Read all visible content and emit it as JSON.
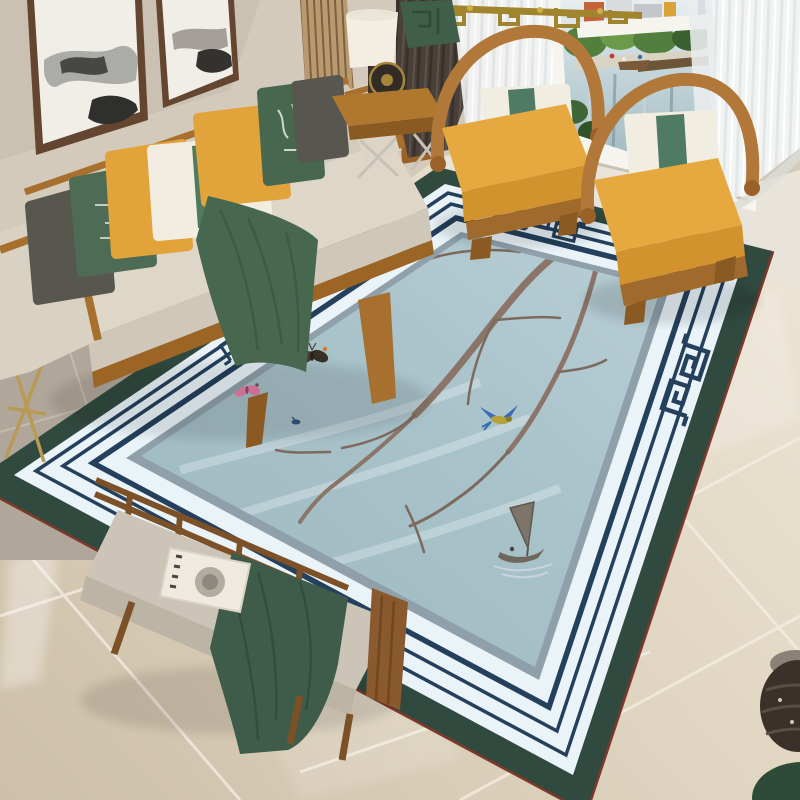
{
  "scene": {
    "description": "living-room with chinese magnolia area rug",
    "items": [
      "ink-paintings",
      "sofa",
      "pillows",
      "side-table-lamp",
      "armchair-left",
      "armchair-right",
      "window-city-view",
      "sheer-curtains",
      "dark-curtain",
      "gold-chandelier",
      "area-rug",
      "bench-with-tray",
      "left-accent-table",
      "corner-vase",
      "green-pouf"
    ]
  },
  "colors": {
    "wall": "#d3cabc",
    "wallShade": "#c3b9aa",
    "grayTile": "#b0a79a",
    "grayGrout": "#c9c1b4",
    "marbleA": "#cdbfa8",
    "marbleB": "#ece4d4",
    "marbleGrout": "#f4efe4",
    "windowFrame": "#f6f4ef",
    "water": "#98b2bb",
    "waterLight": "#c6d7db",
    "trees": "#527e3e",
    "treesDark": "#3a6030",
    "bldOrange": "#c4633a",
    "bldBlue": "#39557f",
    "bldGray": "#c3c7cb",
    "pier": "#6d5638",
    "sheer": "#f2f4f4",
    "darkCurtain": "#49403a",
    "gold": "#a1842e",
    "goldLight": "#cfae4a",
    "sofaFabric": "#dcd5c5",
    "sofaFace": "#cfc8b8",
    "sofaBack": "#d3ccbc",
    "wood": "#ad6f2d",
    "woodDark": "#8a5a22",
    "pillowYellow": "#e2a33b",
    "pillowGreen": "#4d6b55",
    "pillowGreenDark": "#47684f",
    "pillowWhite": "#f1ede0",
    "pillowGray": "#57564f",
    "bandGreen": "#4f7a5f",
    "throwGreen": "#47674f",
    "chairWood": "#b1783a",
    "chairCushion": "#e6a93f",
    "chairCushionSide": "#d2932e",
    "benchWood": "#7d5128",
    "benchCushion": "#ccc4b6",
    "benchFace": "#bcb4a5",
    "benchRunner": "#3e5c49",
    "tray": "#eeeadf",
    "cup": "#b3ada1",
    "rugRedEdge": "#7e382a",
    "rugTeal": "#314a40",
    "rugWhite": "#e9f3f8",
    "rugNavy": "#24405c",
    "rugGray": "#8fa0ab",
    "fieldLight": "#b8ced5",
    "fieldDark": "#9db8bf",
    "branch": "#8b7568",
    "branchDark": "#5e4e44",
    "flowerWhite": "#f7f4ef",
    "flowerPink": "#e8aabe",
    "flowerDeep": "#b84e74",
    "berry": "#e09a2e",
    "berryLight": "#f2bc55",
    "birdNavy": "#2e4668",
    "birdBlue": "#3a6cb5",
    "birdYellow": "#b5a23c",
    "birdOrange": "#bd7a42",
    "bfDark": "#4a3c30",
    "bfOrange": "#cd7a2e",
    "bfPink": "#e77da3",
    "boatInk": "#6f675c",
    "vase": "#3a312a",
    "pouf": "#2e4a38"
  },
  "rug": {
    "flowers": [
      [
        505,
        268,
        1.2,
        0
      ],
      [
        552,
        292,
        1.3,
        36
      ],
      [
        600,
        318,
        1.1,
        -24
      ],
      [
        644,
        344,
        1.0,
        14
      ],
      [
        468,
        298,
        1.05,
        72
      ],
      [
        430,
        264,
        0.9,
        -40
      ],
      [
        524,
        332,
        1.0,
        20
      ],
      [
        572,
        356,
        0.9,
        -60
      ],
      [
        478,
        344,
        0.85,
        100
      ],
      [
        620,
        252,
        0.7,
        30
      ],
      [
        414,
        236,
        0.75,
        -10
      ],
      [
        390,
        396,
        1.0,
        -30
      ],
      [
        352,
        420,
        1.05,
        45
      ],
      [
        315,
        396,
        0.95,
        12
      ],
      [
        282,
        414,
        0.8,
        60
      ],
      [
        368,
        366,
        0.85,
        -80
      ],
      [
        415,
        428,
        0.75,
        140
      ],
      [
        445,
        380,
        0.8,
        -115
      ]
    ],
    "berries": [
      [
        528,
        204,
        4.5
      ],
      [
        543,
        198,
        4
      ],
      [
        557,
        210,
        4.5
      ],
      [
        533,
        222,
        4
      ],
      [
        547,
        232,
        4.5
      ],
      [
        562,
        224,
        4
      ],
      [
        572,
        205,
        3.5
      ],
      [
        566,
        310,
        5
      ],
      [
        580,
        322,
        5
      ],
      [
        592,
        334,
        4.5
      ],
      [
        569,
        339,
        4
      ],
      [
        556,
        326,
        4
      ],
      [
        604,
        352,
        4.5
      ],
      [
        612,
        368,
        4.5
      ],
      [
        468,
        406,
        5
      ],
      [
        454,
        419,
        4.5
      ],
      [
        480,
        428,
        4
      ],
      [
        441,
        434,
        4
      ],
      [
        318,
        430,
        5
      ],
      [
        301,
        443,
        5
      ],
      [
        330,
        452,
        4.5
      ],
      [
        287,
        458,
        4
      ],
      [
        311,
        468,
        4
      ],
      [
        339,
        470,
        4
      ],
      [
        265,
        448,
        4
      ],
      [
        406,
        506,
        4.5
      ],
      [
        419,
        521,
        4.5
      ],
      [
        397,
        531,
        4
      ],
      [
        427,
        544,
        4
      ],
      [
        411,
        556,
        4
      ],
      [
        385,
        492,
        4
      ],
      [
        452,
        252,
        4
      ],
      [
        438,
        246,
        4
      ]
    ]
  }
}
